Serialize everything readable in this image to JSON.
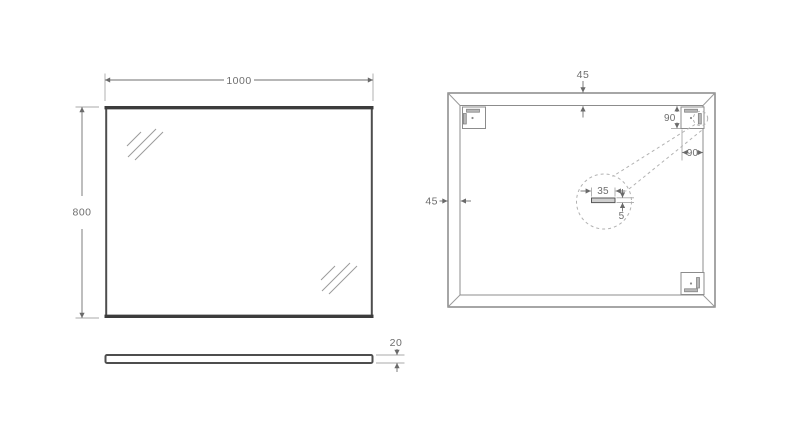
{
  "drawing": {
    "type": "mirror-technical-drawing",
    "background_color": "#ffffff",
    "colors": {
      "mirror_outline_dark": "#3c3c3c",
      "drawing_line_gray": "#8c8c8c",
      "dimension_text_gray": "#6e6e6e",
      "dashed_detail_gray": "#b2b2b2"
    }
  },
  "front_view": {
    "width_label": "1000",
    "height_label": "800"
  },
  "side_view": {
    "thickness_label": "20"
  },
  "back_view": {
    "frame_width_top_label": "45",
    "frame_width_left_label": "45",
    "bracket_offset_vertical_label": "90",
    "bracket_offset_horizontal_label": "90",
    "detail": {
      "slot_width_label": "35",
      "slot_thickness_label": "5"
    }
  }
}
